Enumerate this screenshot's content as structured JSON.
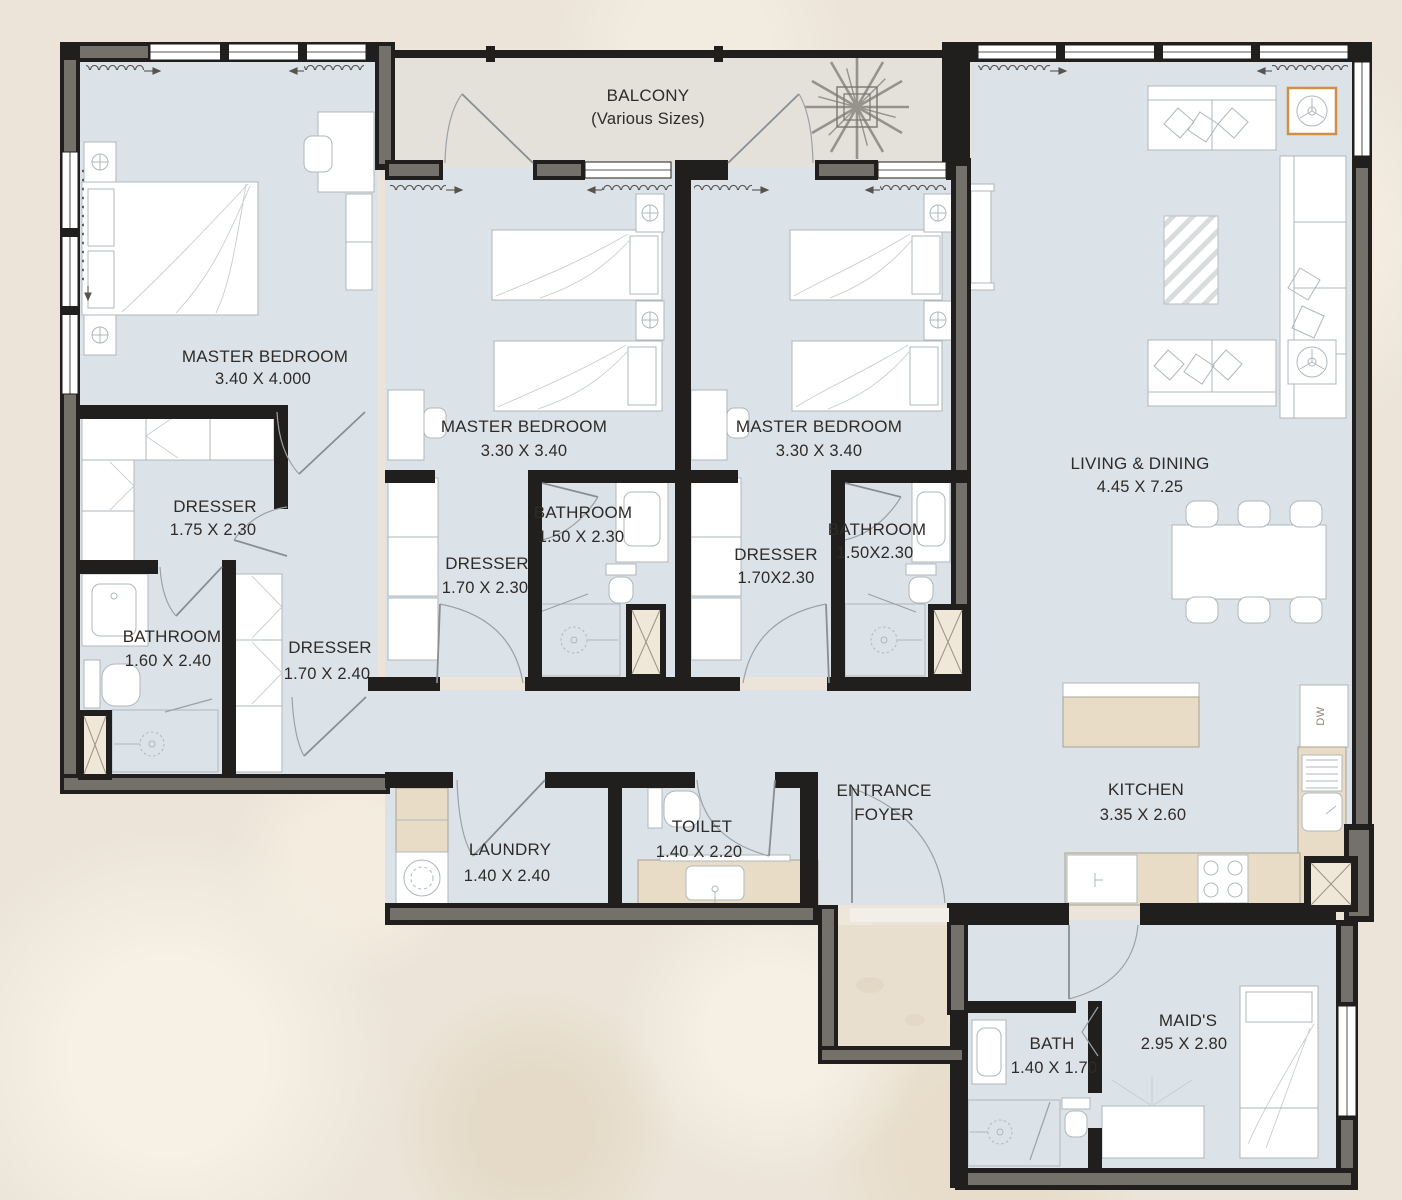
{
  "title": "Apartment Floor Plan",
  "colors": {
    "background": "#ece4d8",
    "floor": "#dce3e8",
    "balcony_floor": "#e4e1da",
    "exterior_patch": "#e9dfcf",
    "wall": "#201f1d",
    "wall_core": "#74706a",
    "counter": "#e9dcc7",
    "furniture_line": "#aeb7bb",
    "accent": "#cf8f45",
    "text": "#2e2b28"
  },
  "rooms": [
    {
      "id": "balcony",
      "name": "BALCONY",
      "dims": "(Various Sizes)"
    },
    {
      "id": "master-1",
      "name": "MASTER BEDROOM",
      "dims": "3.40 X 4.000"
    },
    {
      "id": "master-2",
      "name": "MASTER BEDROOM",
      "dims": "3.30 X 3.40"
    },
    {
      "id": "master-3",
      "name": "MASTER BEDROOM",
      "dims": "3.30 X 3.40"
    },
    {
      "id": "living",
      "name": "LIVING & DINING",
      "dims": "4.45 X 7.25"
    },
    {
      "id": "dresser-1",
      "name": "DRESSER",
      "dims": "1.75 X 2.30"
    },
    {
      "id": "dresser-2",
      "name": "DRESSER",
      "dims": "1.70 X 2.30"
    },
    {
      "id": "bathroom-2",
      "name": "BATHROOM",
      "dims": "1.50 X 2.30"
    },
    {
      "id": "dresser-3",
      "name": "DRESSER",
      "dims": "1.70X2.30"
    },
    {
      "id": "bathroom-3",
      "name": "BATHROOM",
      "dims": "1.50X2.30"
    },
    {
      "id": "bathroom-1",
      "name": "BATHROOM",
      "dims": "1.60 X 2.40"
    },
    {
      "id": "dresser-1b",
      "name": "DRESSER",
      "dims": "1.70 X 2.40"
    },
    {
      "id": "laundry",
      "name": "LAUNDRY",
      "dims": "1.40 X 2.40"
    },
    {
      "id": "toilet",
      "name": "TOILET",
      "dims": "1.40 X 2.20"
    },
    {
      "id": "foyer",
      "name": "ENTRANCE",
      "dims": "FOYER"
    },
    {
      "id": "kitchen",
      "name": "KITCHEN",
      "dims": "3.35 X 2.60"
    },
    {
      "id": "maids",
      "name": "MAID'S",
      "dims": "2.95 X 2.80"
    },
    {
      "id": "bath-maid",
      "name": "BATH",
      "dims": "1.40 X 1.70"
    }
  ],
  "fixtures": {
    "dishwasher": "DW"
  }
}
